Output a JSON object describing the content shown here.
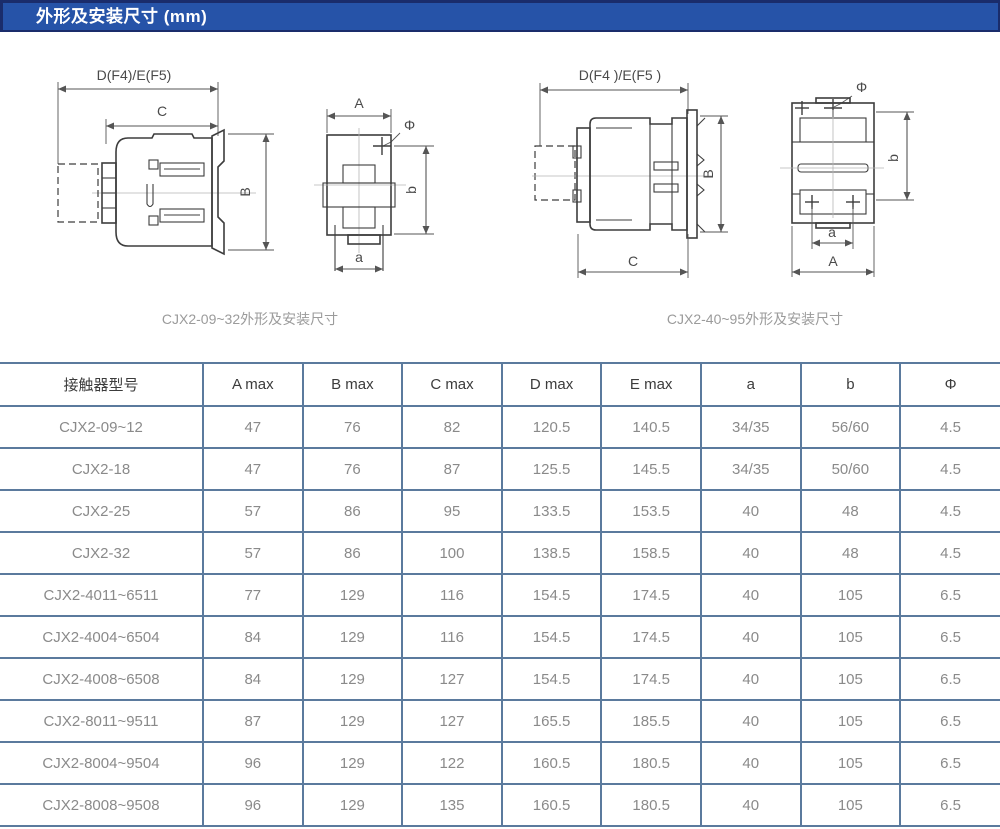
{
  "page": {
    "title": "外形及安装尺寸 (mm)"
  },
  "colors": {
    "header_bg": "#2653a8",
    "header_border": "#1a2c6b",
    "table_border": "#5b7a9d",
    "data_text": "#8a8a8a"
  },
  "drawings": {
    "small": {
      "caption": "CJX2-09~32外形及安装尺寸",
      "labels": {
        "top_width": "D(F4)/E(F5)",
        "depth": "C",
        "height": "B",
        "front_width": "A",
        "hole_dia": "Φ",
        "mount_height": "b",
        "mount_width": "a"
      }
    },
    "large": {
      "caption": "CJX2-40~95外形及安装尺寸",
      "labels": {
        "top_width": "D(F4 )/E(F5 )",
        "depth": "C",
        "height": "B",
        "front_width": "A",
        "hole_dia": "Φ",
        "mount_height": "b",
        "mount_width": "a"
      }
    }
  },
  "table": {
    "headers": [
      "接触器型号",
      "A max",
      "B max",
      "C max",
      "D max",
      "E max",
      "a",
      "b",
      "Φ"
    ],
    "rows": [
      [
        "CJX2-09~12",
        "47",
        "76",
        "82",
        "120.5",
        "140.5",
        "34/35",
        "56/60",
        "4.5"
      ],
      [
        "CJX2-18",
        "47",
        "76",
        "87",
        "125.5",
        "145.5",
        "34/35",
        "50/60",
        "4.5"
      ],
      [
        "CJX2-25",
        "57",
        "86",
        "95",
        "133.5",
        "153.5",
        "40",
        "48",
        "4.5"
      ],
      [
        "CJX2-32",
        "57",
        "86",
        "100",
        "138.5",
        "158.5",
        "40",
        "48",
        "4.5"
      ],
      [
        "CJX2-4011~6511",
        "77",
        "129",
        "116",
        "154.5",
        "174.5",
        "40",
        "105",
        "6.5"
      ],
      [
        "CJX2-4004~6504",
        "84",
        "129",
        "116",
        "154.5",
        "174.5",
        "40",
        "105",
        "6.5"
      ],
      [
        "CJX2-4008~6508",
        "84",
        "129",
        "127",
        "154.5",
        "174.5",
        "40",
        "105",
        "6.5"
      ],
      [
        "CJX2-8011~9511",
        "87",
        "129",
        "127",
        "165.5",
        "185.5",
        "40",
        "105",
        "6.5"
      ],
      [
        "CJX2-8004~9504",
        "96",
        "129",
        "122",
        "160.5",
        "180.5",
        "40",
        "105",
        "6.5"
      ],
      [
        "CJX2-8008~9508",
        "96",
        "129",
        "135",
        "160.5",
        "180.5",
        "40",
        "105",
        "6.5"
      ]
    ]
  }
}
